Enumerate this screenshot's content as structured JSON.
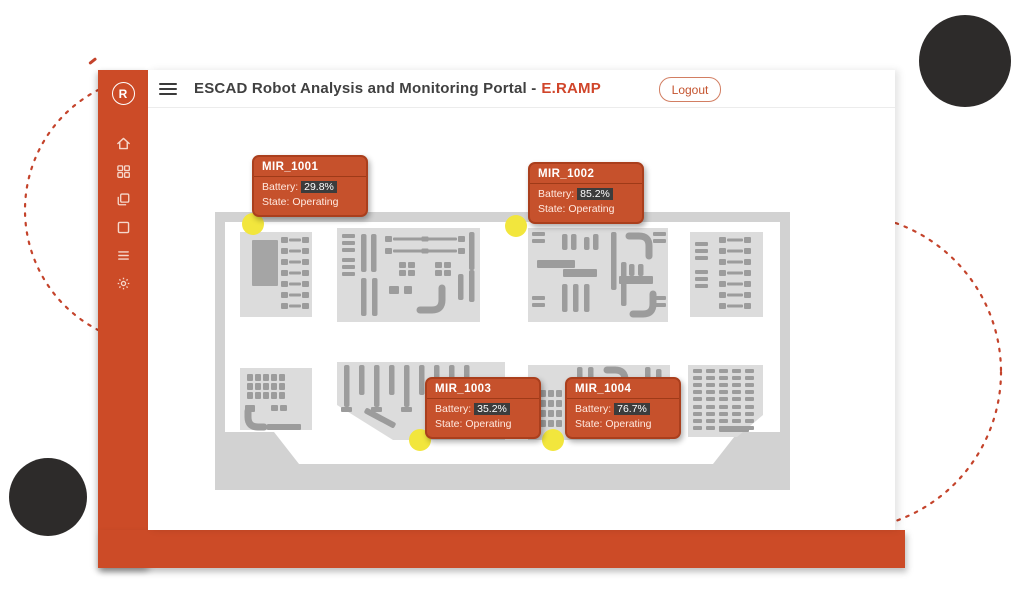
{
  "header": {
    "title_main": "ESCAD Robot Analysis and Monitoring Portal -",
    "title_accent": "E.RAMP",
    "logout_label": "Logout"
  },
  "sidebar": {
    "logo_letter": "R",
    "items": [
      {
        "icon": "home-icon"
      },
      {
        "icon": "dashboard-grid-icon"
      },
      {
        "icon": "copy-pages-icon"
      },
      {
        "icon": "window-icon"
      },
      {
        "icon": "list-icon"
      },
      {
        "icon": "settings-gear-icon"
      }
    ]
  },
  "map": {
    "robots": [
      {
        "name": "MIR_1001",
        "battery_label": "Battery:",
        "battery": "29.8%",
        "state_label": "State:",
        "state": "Operating",
        "dot": {
          "x": 38,
          "y": 12
        },
        "tooltip": {
          "x": 37,
          "y": -57
        }
      },
      {
        "name": "MIR_1002",
        "battery_label": "Battery:",
        "battery": "85.2%",
        "state_label": "State:",
        "state": "Operating",
        "dot": {
          "x": 301,
          "y": 14
        },
        "tooltip": {
          "x": 313,
          "y": -50
        }
      },
      {
        "name": "MIR_1003",
        "battery_label": "Battery:",
        "battery": "35.2%",
        "state_label": "State:",
        "state": "Operating",
        "dot": {
          "x": 205,
          "y": 228
        },
        "tooltip": {
          "x": 210,
          "y": 165
        }
      },
      {
        "name": "MIR_1004",
        "battery_label": "Battery:",
        "battery": "76.7%",
        "state_label": "State:",
        "state": "Operating",
        "dot": {
          "x": 338,
          "y": 228
        },
        "tooltip": {
          "x": 350,
          "y": 165
        }
      }
    ]
  },
  "colors": {
    "primary_orange": "#cc4b27",
    "title_accent": "#d0452a",
    "tooltip_bg": "#c6512c",
    "badge_bg": "#3c3c3c",
    "robot_dot_yellow": "#f2e63d",
    "dark_circle": "#2d2b2a",
    "dashed_circle": "#c4432b",
    "map_frame_gray": "#d2d2d2",
    "map_zone_gray": "#dcdcdc",
    "map_equipment_gray": "#9c9c9c"
  }
}
